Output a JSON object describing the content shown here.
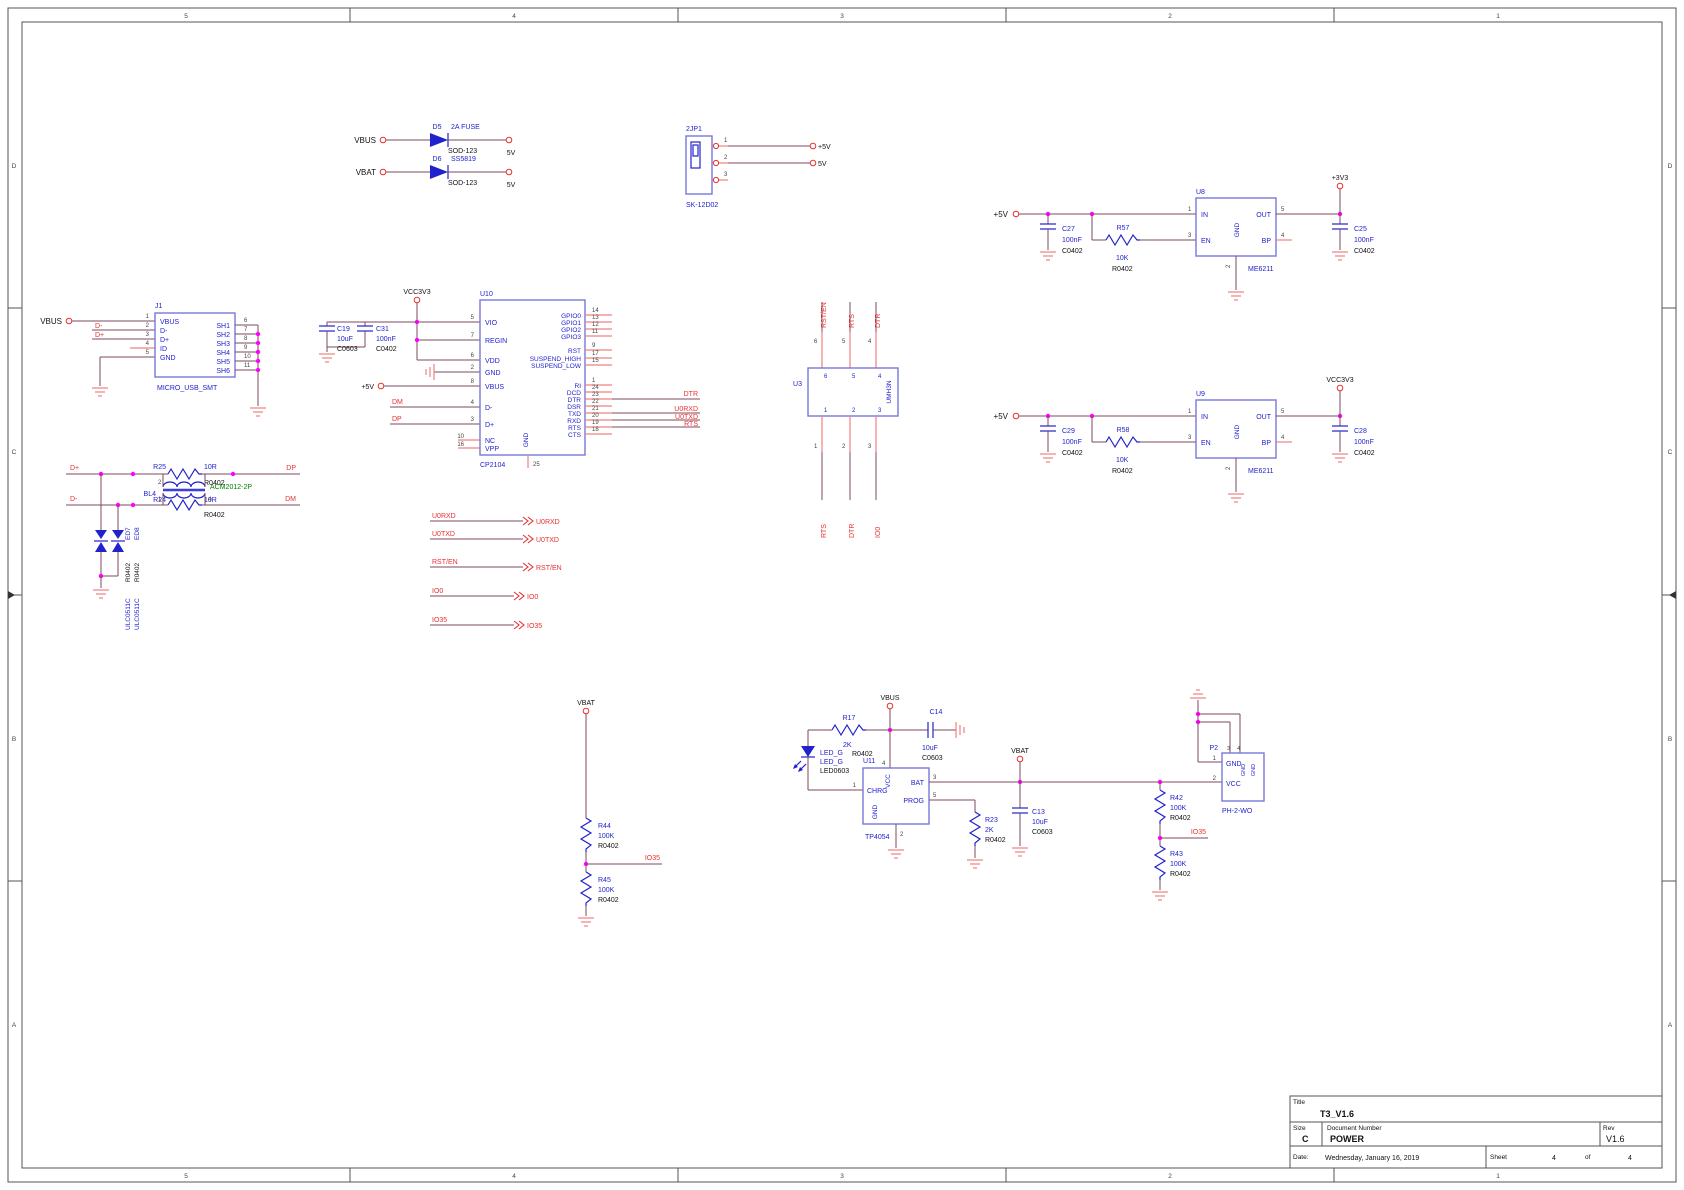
{
  "b": {
    "c0": "5",
    "c1": "4",
    "c2": "3",
    "c3": "2",
    "c4": "1",
    "r0": "D",
    "r1": "C",
    "r2": "B",
    "r3": "A"
  },
  "tb": {
    "title_label": "Title",
    "title": "T3_V1.6",
    "size_label": "Size",
    "size": "C",
    "doc_label": "Document Number",
    "doc": "POWER",
    "rev_label": "Rev",
    "rev": "V1.6",
    "date_label": "Date:",
    "date": "Wednesday, January 16, 2019",
    "sheet_label": "Sheet",
    "sheet": "4",
    "of": "of",
    "total": "4"
  },
  "n": {
    "vbus": "VBUS",
    "vbat": "VBAT",
    "v5": "+5V",
    "v5o": "5V",
    "v3": "+3V3",
    "vcc3": "VCC3V3",
    "dm": "DM",
    "dp": "DP",
    "dmin": "D-",
    "dplu": "D+",
    "dtr": "DTR",
    "rts": "RTS",
    "rst": "RST/EN",
    "urx": "U0RXD",
    "utx": "U0TXD",
    "io0": "IO0",
    "io35": "IO35"
  },
  "r": {
    "d5": "D5",
    "d6": "D6",
    "jp1": "2JP1",
    "j1": "J1",
    "u3": "U3",
    "u8": "U8",
    "u9": "U9",
    "u10": "U10",
    "u11": "U11",
    "p2": "P2",
    "bl4": "BL4",
    "c13": "C13",
    "c14": "C14",
    "c19": "C19",
    "c25": "C25",
    "c27": "C27",
    "c28": "C28",
    "c29": "C29",
    "c31": "C31",
    "r17": "R17",
    "r23": "R23",
    "r24": "R24",
    "r25": "R25",
    "r42": "R42",
    "r43": "R43",
    "r44": "R44",
    "r45": "R45",
    "r57": "R57",
    "r58": "R58",
    "ed7": "ED7",
    "ed8": "ED8"
  },
  "v": {
    "fuse": "2A FUSE",
    "ss": "SS5819",
    "c100n": "100nF",
    "c10u": "10uF",
    "k10": "10K",
    "r10": "10R",
    "k2": "2K",
    "k100": "100K",
    "ledg": "LED_G"
  },
  "f": {
    "sod": "SOD-123",
    "r0402": "R0402",
    "c0402": "C0402",
    "c0603": "C0603",
    "led0603": "LED0603",
    "acm": "ACM2012-2P",
    "ulc": "ULC0511C",
    "me": "ME6211",
    "cp": "CP2104",
    "umh": "UMH3N",
    "musb": "MICRO_USB_SMT",
    "sk": "SK-12D02",
    "tp": "TP4054",
    "ph": "PH-2-WO"
  },
  "p": {
    "in": "IN",
    "out": "OUT",
    "en": "EN",
    "gnd": "GND",
    "bp": "BP",
    "vio": "VIO",
    "regin": "REGIN",
    "vdd": "VDD",
    "vbus": "VBUS",
    "nc": "NC",
    "vpp": "VPP",
    "g0": "GPIO0",
    "g1": "GPIO1",
    "g2": "GPIO2",
    "g3": "GPIO3",
    "rst": "RST",
    "sh": "SUSPEND_HIGH",
    "sl": "SUSPEND_LOW",
    "ri": "RI",
    "dcd": "DCD",
    "dtr": "DTR",
    "dsr": "DSR",
    "txd": "TXD",
    "rxd": "RXD",
    "rts": "RTS",
    "cts": "CTS",
    "dmin": "D-",
    "dplu": "D+",
    "id": "ID",
    "sh1": "SH1",
    "sh2": "SH2",
    "sh3": "SH3",
    "sh4": "SH4",
    "sh5": "SH5",
    "sh6": "SH6",
    "vcc": "VCC",
    "chrg": "CHRG",
    "bat": "BAT",
    "prog": "PROG"
  },
  "d": {
    "n1": "1",
    "n2": "2",
    "n3": "3",
    "n4": "4",
    "n5": "5",
    "n6": "6",
    "n7": "7",
    "n8": "8",
    "n9": "9",
    "n10": "10",
    "n11": "11",
    "n12": "12",
    "n13": "13",
    "n14": "14",
    "n15": "15",
    "n16": "16",
    "n17": "17",
    "n18": "18",
    "n19": "19",
    "n20": "20",
    "n21": "21",
    "n22": "22",
    "n23": "23",
    "n24": "24",
    "n25": "25"
  }
}
